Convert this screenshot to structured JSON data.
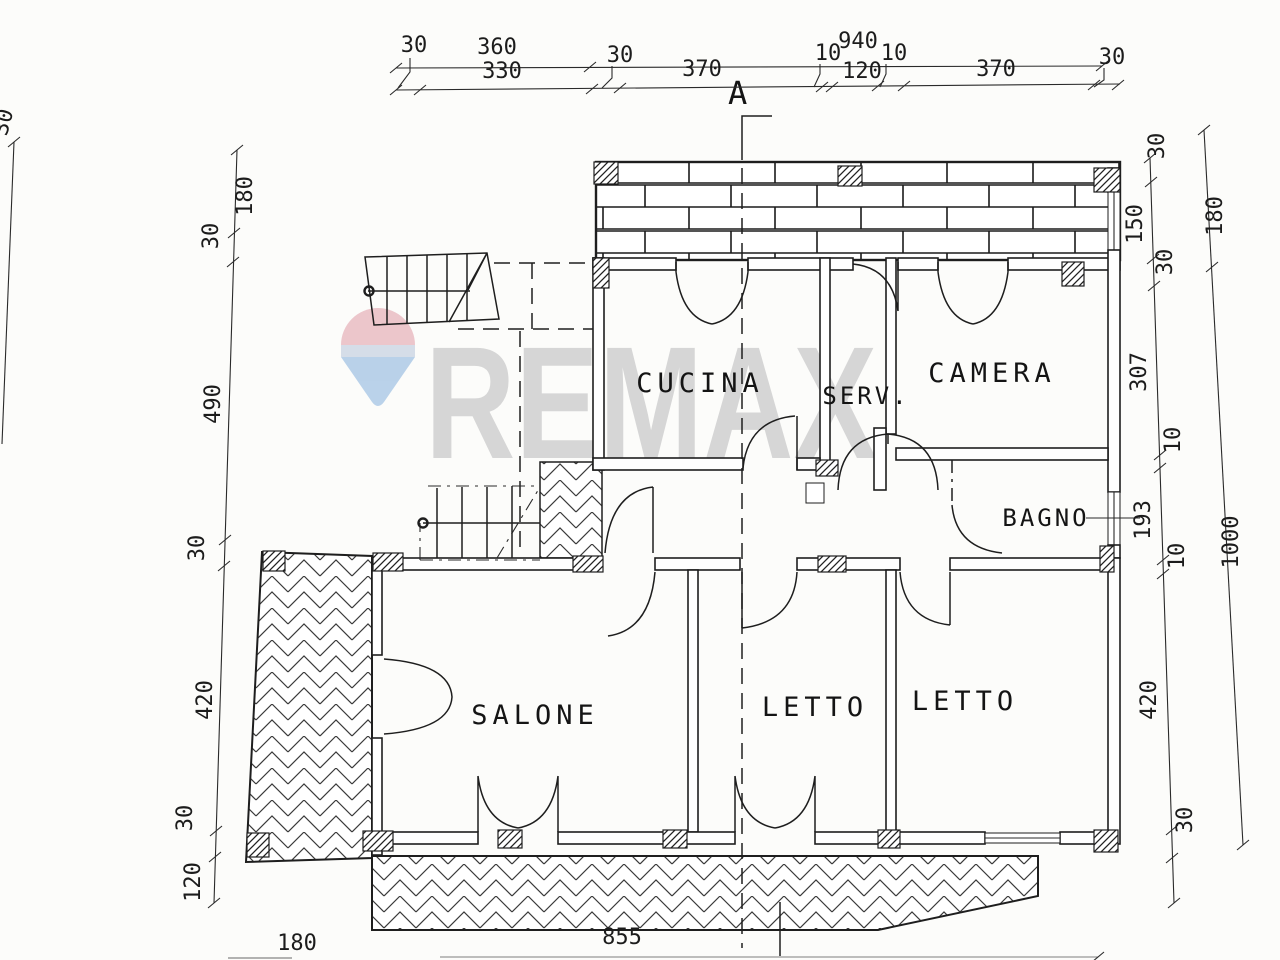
{
  "watermark": {
    "brand": "REMAX",
    "text_color": "#d6d6d6",
    "balloon_colors": {
      "top": "#e9b9c0",
      "band": "#ccd6e4",
      "bottom": "#a9c7e6"
    }
  },
  "section": {
    "label": "A"
  },
  "rooms": [
    {
      "name": "cucina",
      "label": "CUCINA"
    },
    {
      "name": "servizi",
      "label": "SERV."
    },
    {
      "name": "camera",
      "label": "CAMERA"
    },
    {
      "name": "bagno",
      "label": "BAGNO"
    },
    {
      "name": "salone",
      "label": "SALONE"
    },
    {
      "name": "letto-1",
      "label": "LETTO"
    },
    {
      "name": "letto-2",
      "label": "LETTO"
    }
  ],
  "dimensions": {
    "top_row_1": [
      {
        "value": "360"
      },
      {
        "value": "940"
      }
    ],
    "top_row_2": [
      {
        "value": "30"
      },
      {
        "value": "330"
      },
      {
        "value": "30"
      },
      {
        "value": "370"
      },
      {
        "value": "10"
      },
      {
        "value": "120"
      },
      {
        "value": "10"
      },
      {
        "value": "370"
      },
      {
        "value": "30"
      }
    ],
    "left_outer": [
      {
        "value": "30"
      }
    ],
    "left_inner": [
      {
        "value": "180"
      },
      {
        "value": "30"
      },
      {
        "value": "490"
      },
      {
        "value": "30"
      },
      {
        "value": "420"
      },
      {
        "value": "30"
      },
      {
        "value": "120"
      }
    ],
    "right_inner": [
      {
        "value": "30"
      },
      {
        "value": "150"
      },
      {
        "value": "30"
      },
      {
        "value": "307"
      },
      {
        "value": "10"
      },
      {
        "value": "193"
      },
      {
        "value": "10"
      },
      {
        "value": "420"
      },
      {
        "value": "30"
      }
    ],
    "right_outer": [
      {
        "value": "180"
      },
      {
        "value": "1000"
      }
    ],
    "bottom": [
      {
        "value": "180"
      },
      {
        "value": "855"
      }
    ]
  }
}
